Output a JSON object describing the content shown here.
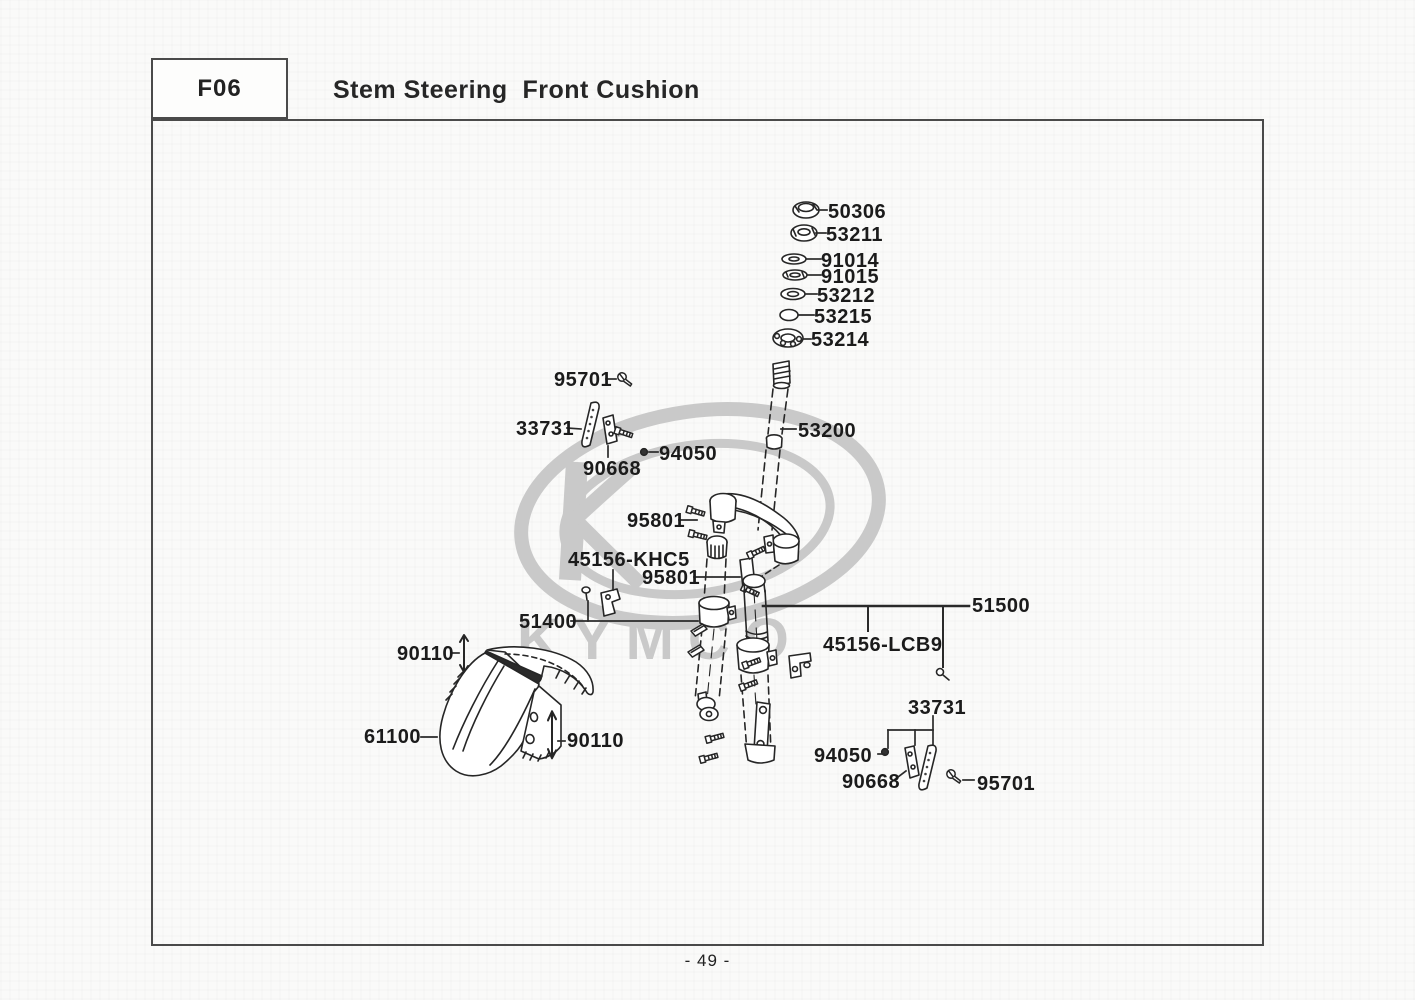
{
  "header": {
    "code": "F06",
    "title": "Stem Steering  Front Cushion"
  },
  "footer": {
    "page_number": "- 49 -"
  },
  "watermark": {
    "text": "KYMCO",
    "color": "#c9c9c9"
  },
  "colors": {
    "ink": "#262626",
    "border": "#4a4a4a",
    "label": "#1b1b1b",
    "background": "#fafaf9"
  },
  "diagram_title": "Stem Steering Front Cushion exploded parts view",
  "part_labels": [
    {
      "text": "50306"
    },
    {
      "text": "53211"
    },
    {
      "text": "91014"
    },
    {
      "text": "91015"
    },
    {
      "text": "53212"
    },
    {
      "text": "53215"
    },
    {
      "text": "53214"
    },
    {
      "text": "95701"
    },
    {
      "text": "33731"
    },
    {
      "text": "90668"
    },
    {
      "text": "94050"
    },
    {
      "text": "53200"
    },
    {
      "text": "95801"
    },
    {
      "text": "45156-KHC5"
    },
    {
      "text": "95801"
    },
    {
      "text": "51400"
    },
    {
      "text": "51500"
    },
    {
      "text": "45156-LCB9"
    },
    {
      "text": "90110"
    },
    {
      "text": "61100"
    },
    {
      "text": "90110"
    },
    {
      "text": "33731"
    },
    {
      "text": "94050"
    },
    {
      "text": "90668"
    },
    {
      "text": "95701"
    }
  ]
}
